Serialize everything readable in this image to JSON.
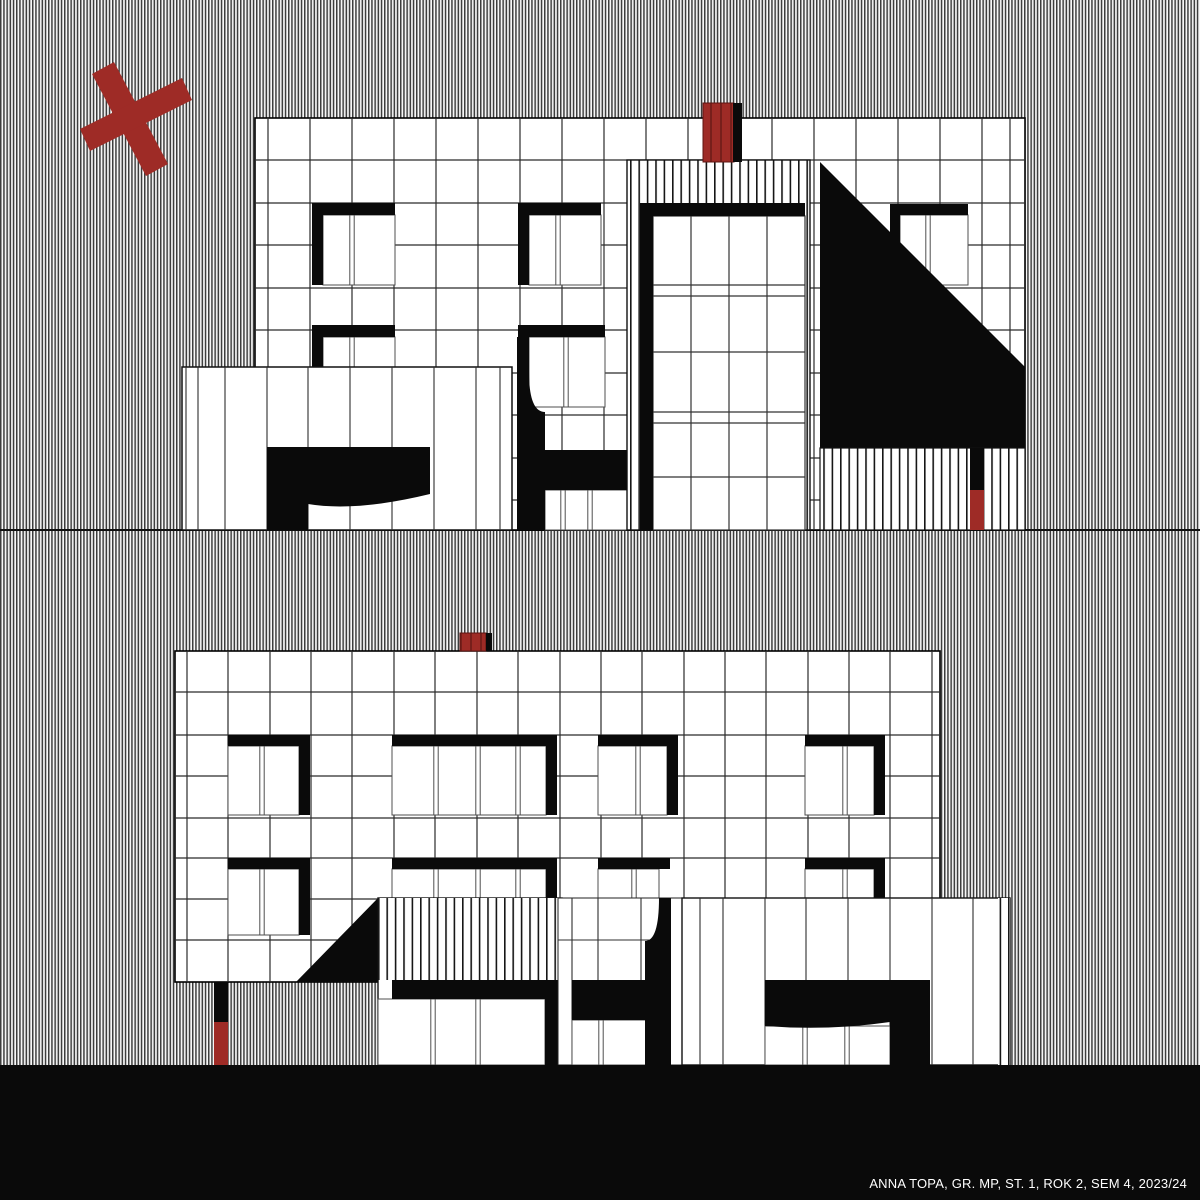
{
  "credit": {
    "text": "ANNA TOPA, GR. MP, ST. 1, ROK 2, SEM 4, 2023/24"
  },
  "colors": {
    "white": "#ffffff",
    "black": "#0a0a0a",
    "red": "#9e2b26",
    "grid": "#2b2b2b",
    "winline": "#4f4f4f",
    "hatch": "url(#p-hatch)",
    "stripe": "url(#p-stripe)",
    "redtex": "url(#p-red)"
  },
  "drawing": {
    "width": 1200,
    "height": 1200,
    "shapes": [
      {
        "name": "background-hatch",
        "type": "rect",
        "r": [
          0,
          0,
          1200,
          1200
        ],
        "fill": "hatch"
      },
      {
        "name": "upper-ground-line",
        "type": "hlines",
        "ys": [
          530
        ],
        "x1": 0,
        "x2": 1200,
        "stroke": "#111111",
        "sw": 2
      },
      {
        "name": "top-facade",
        "type": "rect",
        "r": [
          255,
          118,
          770,
          412
        ],
        "fill": "white",
        "stroke": "#000000",
        "sw": 1.6
      },
      {
        "name": "top-facade-grid-cols",
        "type": "vlines",
        "xs": [
          268,
          310,
          352,
          394,
          436,
          478,
          520,
          562,
          604,
          646,
          688,
          730,
          772,
          814,
          856,
          898,
          940,
          982,
          1010
        ],
        "y1": 118,
        "y2": 530
      },
      {
        "name": "top-facade-grid-rows",
        "type": "hlines",
        "ys": [
          160,
          203,
          245,
          288,
          330,
          373,
          415,
          458,
          500
        ],
        "x1": 255,
        "x2": 1025
      },
      {
        "name": "top-facade-windows",
        "type": "wins",
        "items": [
          [
            323,
            215,
            72,
            70,
            [
              352
            ]
          ],
          [
            529,
            215,
            72,
            70,
            [
              558
            ]
          ],
          [
            900,
            215,
            68,
            70,
            [
              928
            ]
          ],
          [
            323,
            337,
            72,
            70,
            [
              352
            ]
          ],
          [
            529,
            337,
            76,
            70,
            [
              566
            ]
          ],
          [
            545,
            490,
            82,
            40,
            [
              563,
              590
            ]
          ]
        ]
      },
      {
        "name": "top-facade-frame-bars",
        "type": "rects",
        "fill": "black",
        "items": [
          [
            312,
            203,
            83,
            12
          ],
          [
            312,
            203,
            11,
            82
          ],
          [
            518,
            203,
            83,
            12
          ],
          [
            518,
            203,
            11,
            82
          ],
          [
            890,
            204,
            78,
            11
          ],
          [
            890,
            204,
            10,
            80
          ],
          [
            312,
            325,
            83,
            12
          ],
          [
            312,
            325,
            11,
            82
          ],
          [
            518,
            325,
            87,
            12
          ],
          [
            545,
            450,
            82,
            40
          ]
        ]
      },
      {
        "name": "top-curved-column",
        "type": "path",
        "d": "M517,337 L529,337 L529,372 Q529,412 545,412 L545,530 L517,530 Z",
        "fill": "black"
      },
      {
        "name": "top-left-annex",
        "type": "rect",
        "r": [
          182,
          367,
          330,
          163
        ],
        "fill": "white",
        "stroke": "#111111",
        "sw": 1.5
      },
      {
        "name": "top-left-annex-panel-lines",
        "type": "vlines",
        "xs": [
          186,
          198,
          225,
          267,
          308,
          350,
          392,
          434,
          476,
          500
        ],
        "y1": 367,
        "y2": 530,
        "stroke": "#2f2f2f",
        "sw": 1.1
      },
      {
        "name": "top-left-annex-black-mass",
        "type": "path",
        "d": "M267,447 L430,447 L430,494 Q356,512 308,504 L308,530 L267,530 Z",
        "fill": "black"
      },
      {
        "name": "top-door-bay",
        "type": "rect",
        "r": [
          627,
          160,
          183,
          370
        ],
        "fill": "stripe",
        "stroke": "#111111",
        "sw": 1.4
      },
      {
        "name": "top-door-panes",
        "type": "rect",
        "r": [
          653,
          216,
          152,
          314
        ],
        "fill": "white",
        "stroke": "#333333",
        "sw": 1.2
      },
      {
        "name": "top-door-mullions-v",
        "type": "vlines",
        "xs": [
          691,
          729,
          767
        ],
        "y1": 216,
        "y2": 530,
        "stroke": "#333333",
        "sw": 1.2
      },
      {
        "name": "top-door-mullions-h",
        "type": "hlines",
        "ys": [
          285,
          296,
          352,
          412,
          423,
          477
        ],
        "x1": 653,
        "x2": 805,
        "stroke": "#333333",
        "sw": 1.2
      },
      {
        "name": "top-door-frame",
        "type": "rects",
        "fill": "black",
        "items": [
          [
            640,
            203,
            165,
            13
          ],
          [
            640,
            203,
            13,
            327
          ]
        ]
      },
      {
        "name": "top-chimney",
        "type": "rect",
        "r": [
          703,
          103,
          31,
          59
        ],
        "fill": "redtex",
        "stroke": "#5f1512",
        "sw": 1
      },
      {
        "name": "top-chimney-edge",
        "type": "rects",
        "fill": "black",
        "items": [
          [
            733,
            103,
            9,
            59
          ]
        ]
      },
      {
        "name": "top-black-triangle",
        "type": "path",
        "d": "M820,162 L1025,367 L1025,448 L820,448 Z",
        "fill": "black"
      },
      {
        "name": "top-base-stripes",
        "type": "rect",
        "r": [
          820,
          448,
          205,
          82
        ],
        "fill": "stripe",
        "stroke": "#111111",
        "sw": 1.2
      },
      {
        "name": "top-post",
        "type": "rects",
        "fill": "black",
        "items": [
          [
            970,
            448,
            14,
            42
          ]
        ]
      },
      {
        "name": "top-post-red",
        "type": "rects",
        "fill": "red",
        "items": [
          [
            970,
            490,
            14,
            40
          ]
        ]
      },
      {
        "name": "bottom-facade",
        "type": "rect",
        "r": [
          175,
          651,
          765,
          331
        ],
        "fill": "white",
        "stroke": "#000000",
        "sw": 1.6
      },
      {
        "name": "bottom-facade-grid-cols",
        "type": "vlines",
        "xs": [
          187,
          228,
          270,
          311,
          352,
          394,
          435,
          477,
          518,
          560,
          601,
          642,
          684,
          725,
          766,
          808,
          849,
          890,
          932
        ],
        "y1": 651,
        "y2": 982
      },
      {
        "name": "bottom-facade-grid-rows",
        "type": "hlines",
        "ys": [
          692,
          735,
          776,
          818,
          858,
          899,
          940
        ],
        "x1": 175,
        "x2": 940
      },
      {
        "name": "bottom-facade-windows",
        "type": "wins",
        "items": [
          [
            228,
            746,
            71,
            69,
            [
              262
            ]
          ],
          [
            392,
            746,
            154,
            69,
            [
              436,
              478,
              518
            ]
          ],
          [
            598,
            746,
            69,
            69,
            [
              638
            ]
          ],
          [
            805,
            746,
            69,
            69,
            [
              845
            ]
          ],
          [
            228,
            869,
            71,
            66,
            [
              262
            ]
          ],
          [
            392,
            869,
            154,
            66,
            [
              436,
              478,
              518
            ]
          ],
          [
            598,
            869,
            61,
            66,
            [
              634
            ]
          ],
          [
            805,
            869,
            69,
            29,
            [
              845
            ]
          ]
        ]
      },
      {
        "name": "bottom-facade-frame-bars",
        "type": "rects",
        "fill": "black",
        "items": [
          [
            228,
            735,
            82,
            11
          ],
          [
            299,
            746,
            11,
            69
          ],
          [
            392,
            735,
            165,
            11
          ],
          [
            546,
            746,
            11,
            69
          ],
          [
            598,
            735,
            80,
            11
          ],
          [
            667,
            746,
            11,
            69
          ],
          [
            805,
            735,
            80,
            11
          ],
          [
            874,
            746,
            11,
            69
          ],
          [
            228,
            858,
            82,
            11
          ],
          [
            299,
            869,
            11,
            66
          ],
          [
            392,
            858,
            165,
            11
          ],
          [
            546,
            869,
            11,
            29
          ],
          [
            598,
            858,
            72,
            11
          ],
          [
            805,
            858,
            80,
            11
          ],
          [
            874,
            869,
            11,
            29
          ]
        ]
      },
      {
        "name": "bottom-chimney",
        "type": "rect",
        "r": [
          460,
          633,
          26,
          18
        ],
        "fill": "redtex",
        "stroke": "#5f1512",
        "sw": 1
      },
      {
        "name": "bottom-chimney-edge",
        "type": "rects",
        "fill": "black",
        "items": [
          [
            486,
            633,
            6,
            18
          ]
        ]
      },
      {
        "name": "bottom-black-triangle",
        "type": "path",
        "d": "M296,982 L378,898 L378,982 Z",
        "fill": "black"
      },
      {
        "name": "bottom-mid-annex",
        "type": "rect",
        "r": [
          378,
          898,
          184,
          167
        ],
        "fill": "white",
        "stroke": "#111111",
        "sw": 1.4
      },
      {
        "name": "bottom-mid-annex-stripes",
        "type": "rect",
        "r": [
          378,
          898,
          184,
          82
        ],
        "fill": "stripe"
      },
      {
        "name": "bottom-mid-annex-windows",
        "type": "wins",
        "items": [
          [
            378,
            999,
            167,
            66,
            [
              433,
              478
            ]
          ]
        ]
      },
      {
        "name": "bottom-mid-annex-bars",
        "type": "rects",
        "fill": "black",
        "items": [
          [
            392,
            980,
            170,
            19
          ],
          [
            545,
            980,
            17,
            85
          ]
        ]
      },
      {
        "name": "bottom-midzone",
        "type": "rect",
        "r": [
          558,
          898,
          124,
          167
        ],
        "fill": "white",
        "stroke": "#222222",
        "sw": 1
      },
      {
        "name": "bottom-midzone-lines",
        "type": "vlines",
        "xs": [
          572,
          598,
          641
        ],
        "y1": 898,
        "y2": 1065,
        "stroke": "#2f2f2f",
        "sw": 1.1
      },
      {
        "name": "bottom-midzone-row",
        "type": "hlines",
        "ys": [
          940
        ],
        "x1": 558,
        "x2": 671,
        "stroke": "#2f2f2f",
        "sw": 1.1
      },
      {
        "name": "bottom-midzone-windows",
        "type": "wins",
        "items": [
          [
            572,
            1020,
            80,
            45,
            [
              601
            ]
          ]
        ]
      },
      {
        "name": "bottom-midzone-block",
        "type": "rects",
        "fill": "black",
        "items": [
          [
            572,
            980,
            80,
            40
          ]
        ]
      },
      {
        "name": "bottom-curved-column",
        "type": "path",
        "d": "M659,898 L671,898 L671,1065 L645,1065 L645,941 Q659,941 659,898 Z",
        "fill": "black"
      },
      {
        "name": "bottom-right-annex",
        "type": "rect",
        "r": [
          682,
          898,
          328,
          167
        ],
        "fill": "white",
        "stroke": "#111111",
        "sw": 1.4
      },
      {
        "name": "bottom-right-annex-lines",
        "type": "vlines",
        "xs": [
          700,
          723,
          765,
          806,
          848,
          890,
          932,
          973
        ],
        "y1": 898,
        "y2": 1065,
        "stroke": "#2f2f2f",
        "sw": 1.1
      },
      {
        "name": "bottom-right-annex-stripecol",
        "type": "rect",
        "r": [
          998,
          898,
          12,
          167
        ],
        "fill": "stripe"
      },
      {
        "name": "bottom-right-annex-windows",
        "type": "wins",
        "items": [
          [
            765,
            1026,
            125,
            39,
            [
              805,
              847
            ]
          ]
        ]
      },
      {
        "name": "bottom-right-annex-black",
        "type": "path",
        "d": "M765,980 L930,980 L930,1065 L890,1065 L890,1022 Q828,1031 765,1026 Z",
        "fill": "black"
      },
      {
        "name": "bottom-post",
        "type": "rects",
        "fill": "black",
        "items": [
          [
            214,
            982,
            14,
            40
          ]
        ]
      },
      {
        "name": "bottom-post-red",
        "type": "rects",
        "fill": "red",
        "items": [
          [
            214,
            1022,
            14,
            43
          ]
        ]
      },
      {
        "name": "ground-band",
        "type": "rect",
        "r": [
          0,
          1065,
          1200,
          135
        ],
        "fill": "black"
      },
      {
        "name": "red-x-bar-1",
        "type": "path",
        "d": "M92,74 L114,62 L168,164 L146,176 Z",
        "fill": "red"
      },
      {
        "name": "red-x-bar-2",
        "type": "path",
        "d": "M90,151 L80,129 L182,78 L192,100 Z",
        "fill": "red"
      }
    ]
  }
}
